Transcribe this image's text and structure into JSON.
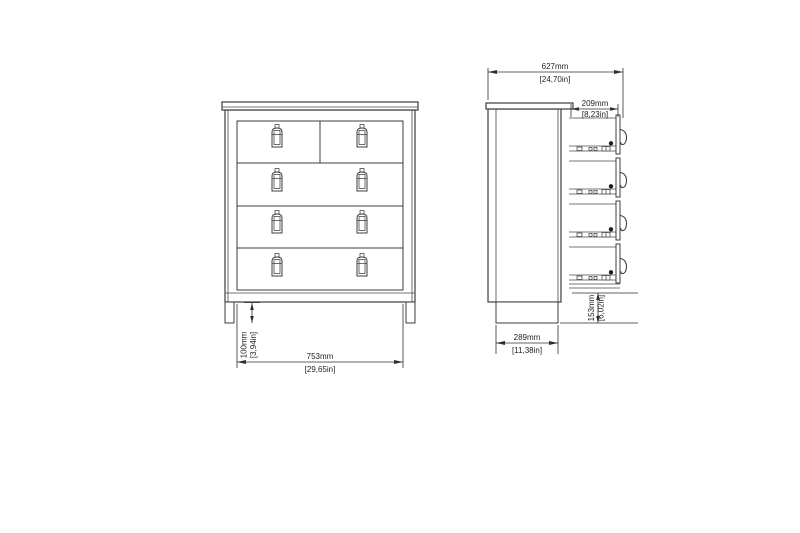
{
  "diagram": {
    "background": "#ffffff",
    "stroke_color": "#3d3d3d",
    "text_color": "#1f1f1f",
    "views": {
      "front": {
        "drawer_rows": 4,
        "top_row_drawer_count": 2,
        "handle_count": 8
      },
      "side": {
        "drawer_count": 4
      }
    },
    "dimensions": {
      "overall_width": {
        "mm": "753mm",
        "inches": "[29,65in]"
      },
      "plinth_height": {
        "mm": "100mm",
        "inches": "[3,94in]"
      },
      "overall_depth": {
        "mm": "627mm",
        "inches": "[24,70in]"
      },
      "drawer_depth": {
        "mm": "209mm",
        "inches": "[8,23in]"
      },
      "base_depth": {
        "mm": "289mm",
        "inches": "[11,38in]"
      },
      "bottom_height": {
        "mm": "153mm",
        "inches": "[6,02in]"
      }
    }
  }
}
